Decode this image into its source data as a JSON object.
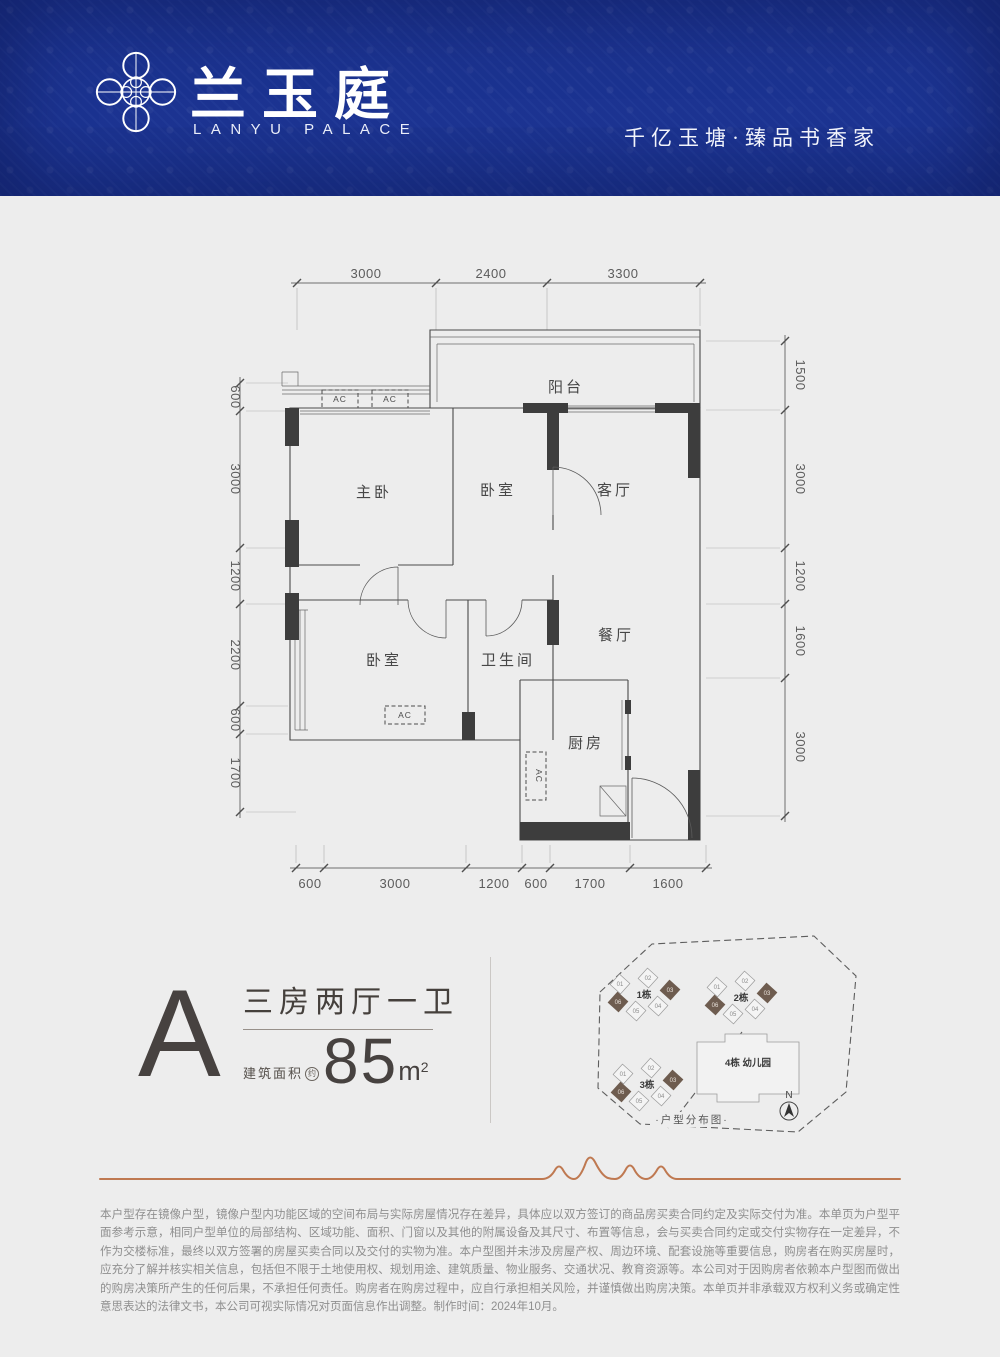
{
  "header": {
    "brand": "兰玉庭",
    "brand_en": "LANYU PALACE",
    "tagline": "千亿玉塘·臻品书香家"
  },
  "floorplan": {
    "dims_top": [
      "3000",
      "2400",
      "3300"
    ],
    "dims_left": [
      "600",
      "3000",
      "1200",
      "2200",
      "600",
      "1700"
    ],
    "dims_right": [
      "1500",
      "3000",
      "1200",
      "1600",
      "3000"
    ],
    "dims_bottom": [
      "600",
      "3000",
      "1200",
      "600",
      "1700",
      "1600"
    ],
    "rooms": {
      "balcony": "阳台",
      "master_bedroom": "主卧",
      "bedroom2": "卧室",
      "living": "客厅",
      "dining": "餐厅",
      "bedroom3": "卧室",
      "bathroom": "卫生间",
      "kitchen": "厨房"
    },
    "ac_label": "AC"
  },
  "unit": {
    "type_letter": "A",
    "layout": "三房两厅一卫",
    "area_prefix": "建筑面积",
    "area_approx": "约",
    "area_value": "85",
    "area_unit": "m",
    "area_sup": "2"
  },
  "siteplan": {
    "buildings": [
      {
        "label": "1栋",
        "units": [
          "01",
          "02",
          "03",
          "04",
          "05",
          "06"
        ],
        "highlighted": [
          "03",
          "06"
        ]
      },
      {
        "label": "2栋",
        "units": [
          "01",
          "02",
          "03",
          "04",
          "05",
          "06"
        ],
        "highlighted": [
          "03",
          "06"
        ]
      },
      {
        "label": "3栋",
        "units": [
          "01",
          "02",
          "03",
          "04",
          "05",
          "06"
        ],
        "highlighted": [
          "03",
          "06"
        ]
      },
      {
        "label": "4栋 幼儿园"
      }
    ],
    "caption": "·户型分布图·",
    "compass_label": "N",
    "highlight_color": "#6e5c4f"
  },
  "footer": {
    "disclaimer": "本户型存在镜像户型，镜像户型内功能区域的空间布局与实际房屋情况存在差异，具体应以双方签订的商品房买卖合同约定及实际交付为准。本单页为户型平面参考示意，相同户型单位的局部结构、区域功能、面积、门窗以及其他的附属设备及其尺寸、布置等信息，会与买卖合同约定或交付实物存在一定差异，不作为交楼标准，最终以双方签署的房屋买卖合同以及交付的实物为准。本户型图并未涉及房屋产权、周边环境、配套设施等重要信息，购房者在购买房屋时，应充分了解并核实相关信息，包括但不限于土地使用权、规划用途、建筑质量、物业服务、交通状况、教育资源等。本公司对于因购房者依赖本户型图而做出的购房决策所产生的任何后果，不承担任何责任。购房者在购房过程中，应自行承担相关风险，并谨慎做出购房决策。本单页并非承载双方权利义务或确定性意思表达的法律文书，本公司可视实际情况对页面信息作出调整。制作时间：2024年10月。"
  },
  "colors": {
    "header_blue": "#1c3493",
    "accent_copper": "#bf7951",
    "wall_dark": "#3d3d3d",
    "page_bg": "#ededed"
  }
}
